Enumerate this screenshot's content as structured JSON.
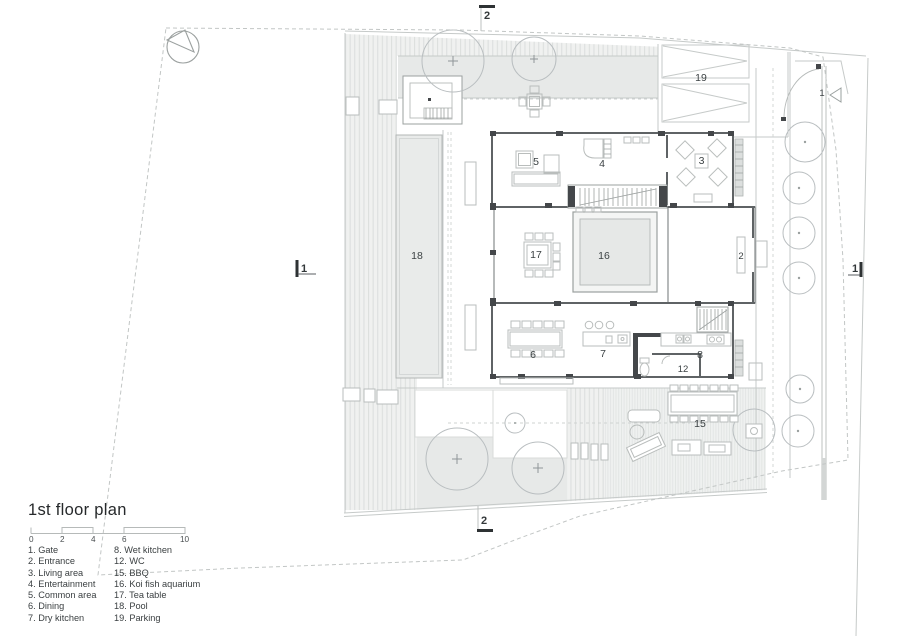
{
  "legend": {
    "title": "1st floor plan",
    "scale_ticks": [
      "0",
      "2",
      "4",
      "6",
      "10"
    ],
    "col1": [
      "1. Gate",
      "2. Entrance",
      "3. Living area",
      "4. Entertainment",
      "5. Common area",
      "6. Dining",
      "7. Dry kitchen"
    ],
    "col2": [
      "8. Wet kitchen",
      "12. WC",
      "15. BBQ",
      "16. Koi fish aquarium",
      "17. Tea table",
      "18. Pool",
      "19. Parking"
    ]
  },
  "plan": {
    "labels": {
      "gate": "1",
      "entrance": "2",
      "living_area": "3",
      "entertainment": "4",
      "common_area": "5",
      "dining": "6",
      "dry_kitchen": "7",
      "wet_kitchen": "8",
      "wc": "12",
      "bbq": "15",
      "koi_aquarium": "16",
      "tea_table": "17",
      "pool": "18",
      "parking": "19"
    },
    "section_markers": {
      "top": "2",
      "bottom": "2",
      "left": "1",
      "right": "1"
    },
    "colors": {
      "wall": "#5f6365",
      "line_light": "#c6cac9",
      "planted_fill": "#e7e9e8",
      "text": "#3c4244"
    }
  }
}
